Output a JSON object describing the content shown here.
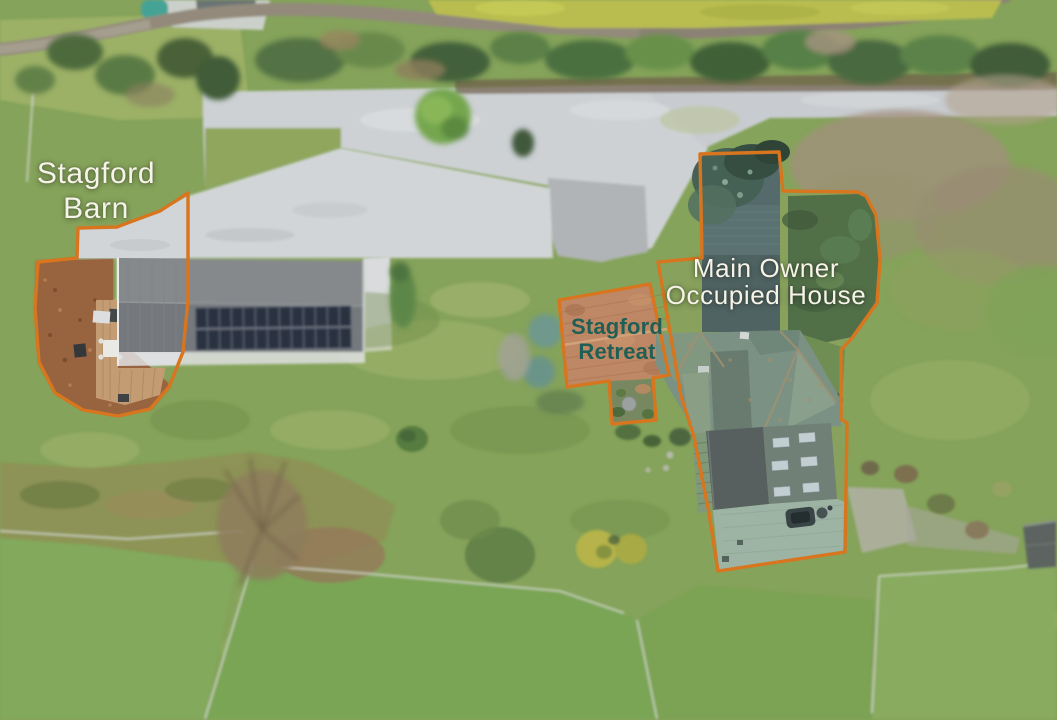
{
  "annotations": {
    "barn": {
      "line1": "Stagford",
      "line2": "Barn"
    },
    "retreat": {
      "line1": "Stagford",
      "line2": "Retreat"
    },
    "house": {
      "line1": "Main Owner",
      "line2": "Occupied House"
    }
  },
  "colors": {
    "boundary_orange": "#d8751f",
    "barn_house_label_white": "#f6f3e9",
    "retreat_label_teal": "#1f5f55"
  }
}
